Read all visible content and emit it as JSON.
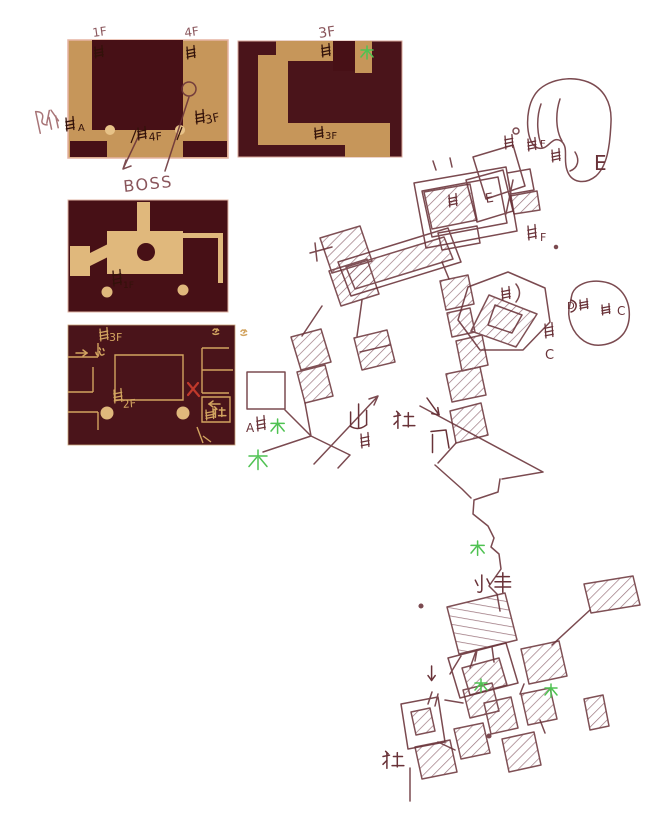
{
  "palette": {
    "paper": "#ffffff",
    "maroon": "#471016",
    "tan_map": "#c6965a",
    "tan_light": "#e7c288",
    "tan_room": "#e0b87c",
    "tan_line": "#d2a460",
    "pen": "#693238",
    "pen_soft": "#8a565c",
    "ink": "#33120a",
    "green": "#4fc252",
    "red": "#c0392b",
    "pink": "#a87578"
  },
  "floor_maps": [
    {
      "name": "floor-map-1",
      "top_labels": [
        "1F",
        "4F"
      ],
      "inner_labels": [
        "A",
        "4F",
        "3F"
      ],
      "callout": "BOSS"
    },
    {
      "name": "floor-map-2",
      "top_labels": [
        "3F"
      ],
      "inner_labels": [
        "3F"
      ],
      "marks": [
        "木"
      ]
    },
    {
      "name": "floor-map-3",
      "inner_labels": [
        "1F"
      ]
    },
    {
      "name": "floor-map-4",
      "inner_labels": [
        "3F",
        "心",
        "2F",
        "社"
      ],
      "marks": [
        "→",
        "←",
        "✕",
        "逃",
        "遥"
      ]
    }
  ],
  "sketch_labels": [
    {
      "t": "1F",
      "x": 93,
      "y": 37,
      "s": 12,
      "c": "pen_soft",
      "r": -8,
      "name": "label-map1-1f"
    },
    {
      "t": "4F",
      "x": 185,
      "y": 37,
      "s": 12,
      "c": "pen_soft",
      "r": -8,
      "name": "label-map1-4f"
    },
    {
      "t": "3F",
      "x": 319,
      "y": 38,
      "s": 14,
      "c": "pen_soft",
      "r": -8,
      "name": "label-map2-3f"
    },
    {
      "t": "4F",
      "x": 149,
      "y": 141,
      "s": 11,
      "c": "ink",
      "r": -5,
      "name": "label-stairs-4f"
    },
    {
      "t": "3F",
      "x": 206,
      "y": 124,
      "s": 12,
      "c": "ink",
      "r": -12,
      "name": "label-stairs-3f"
    },
    {
      "t": "A",
      "x": 78,
      "y": 131,
      "s": 10,
      "c": "ink",
      "r": 0,
      "name": "label-stairs-a"
    },
    {
      "t": "BOSS",
      "x": 124,
      "y": 192,
      "s": 16,
      "c": "pen_soft",
      "r": -6,
      "ls": 1.5,
      "name": "label-boss"
    },
    {
      "t": "3F",
      "x": 325,
      "y": 139,
      "s": 10,
      "c": "ink",
      "r": 0,
      "name": "label-map2-stairs-3f"
    },
    {
      "t": "1F",
      "x": 123,
      "y": 288,
      "s": 9,
      "c": "ink",
      "r": 0,
      "name": "label-map3-stairs-1f"
    },
    {
      "t": "3F",
      "x": 109,
      "y": 341,
      "s": 11,
      "c": "tan_line",
      "r": 0,
      "name": "label-map4-stairs-3f"
    },
    {
      "t": "2F",
      "x": 123,
      "y": 408,
      "s": 11,
      "c": "tan_line",
      "r": -5,
      "name": "label-map4-stairs-2f"
    },
    {
      "t": "E",
      "x": 594,
      "y": 170,
      "s": 20,
      "c": "pen",
      "r": 0,
      "name": "label-area-e"
    },
    {
      "t": "E",
      "x": 486,
      "y": 203,
      "s": 13,
      "c": "pen",
      "r": -10,
      "name": "label-area-e2"
    },
    {
      "t": "F",
      "x": 540,
      "y": 147,
      "s": 10,
      "c": "pen",
      "r": 0,
      "name": "label-area-f"
    },
    {
      "t": "F",
      "x": 540,
      "y": 241,
      "s": 11,
      "c": "pen",
      "r": 0,
      "name": "label-area-f2"
    },
    {
      "t": "C",
      "x": 545,
      "y": 359,
      "s": 13,
      "c": "pen",
      "r": 0,
      "name": "label-area-c"
    },
    {
      "t": "C",
      "x": 617,
      "y": 315,
      "s": 12,
      "c": "pen",
      "r": 0,
      "name": "label-area-c2"
    },
    {
      "t": "D",
      "x": 567,
      "y": 309,
      "s": 10,
      "c": "pen",
      "r": 0,
      "name": "label-area-d"
    },
    {
      "t": "A",
      "x": 246,
      "y": 432,
      "s": 12,
      "c": "pen",
      "r": 0,
      "name": "label-area-a"
    }
  ],
  "glyphs": [
    {
      "char": "阶",
      "type": "jie",
      "x": 34,
      "y": 112,
      "s": 1.7,
      "c": "pink",
      "r": -12,
      "name": "stairs-character-glyph"
    },
    {
      "char": "木",
      "type": "mu",
      "x": 361,
      "y": 46,
      "s": 1.0,
      "c": "green",
      "name": "tree-mark-map2"
    },
    {
      "char": "心",
      "type": "xin",
      "x": 95,
      "y": 347,
      "s": 0.9,
      "c": "tan_line",
      "name": "heart-character-glyph"
    },
    {
      "char": "→",
      "type": "arrowr",
      "x": 76,
      "y": 351,
      "s": 1,
      "c": "tan_line",
      "name": "arrow-right-icon"
    },
    {
      "char": "←",
      "type": "arrowl",
      "x": 208,
      "y": 402,
      "s": 1,
      "c": "tan_line",
      "name": "arrow-left-icon"
    },
    {
      "char": "社",
      "type": "she",
      "x": 213,
      "y": 406,
      "s": 0.8,
      "c": "tan_line",
      "name": "shrine-character-map4"
    },
    {
      "char": "逃",
      "type": "squig",
      "x": 213,
      "y": 328,
      "s": 0.8,
      "c": "tan_line",
      "name": "escape-character-glyph"
    },
    {
      "char": "遥",
      "type": "squig",
      "x": 241,
      "y": 329,
      "s": 0.8,
      "c": "tan_line",
      "name": "far-character-glyph"
    },
    {
      "char": "木",
      "type": "mu",
      "x": 271,
      "y": 419,
      "s": 1.1,
      "c": "green",
      "name": "tree-mark-a"
    },
    {
      "char": "木",
      "type": "mu",
      "x": 249,
      "y": 450,
      "s": 1.5,
      "c": "green",
      "name": "tree-mark-a2"
    },
    {
      "char": "山",
      "type": "shan",
      "x": 349,
      "y": 404,
      "s": 1.6,
      "c": "pen",
      "name": "mountain-character-glyph"
    },
    {
      "char": "社",
      "type": "she",
      "x": 394,
      "y": 410,
      "s": 1.3,
      "c": "pen",
      "name": "shrine-character-mid"
    },
    {
      "char": "↓",
      "type": "arrowdr",
      "x": 427,
      "y": 398,
      "s": 1.2,
      "c": "pen",
      "name": "arrow-down-icon"
    },
    {
      "char": "门",
      "type": "men",
      "x": 431,
      "y": 430,
      "s": 1.5,
      "c": "pen",
      "name": "gate-character-glyph"
    },
    {
      "char": "木",
      "type": "mu",
      "x": 471,
      "y": 541,
      "s": 1.1,
      "c": "green",
      "name": "tree-mark-path"
    },
    {
      "char": "小",
      "type": "xiao",
      "x": 474,
      "y": 575,
      "s": 1.3,
      "c": "pen",
      "name": "small-character-glyph"
    },
    {
      "char": "丰",
      "type": "feng",
      "x": 495,
      "y": 574,
      "s": 1.3,
      "c": "pen",
      "name": "feng-character-glyph"
    },
    {
      "char": "↓",
      "type": "arrowd",
      "x": 428,
      "y": 666,
      "s": 1.2,
      "c": "pen",
      "name": "arrow-down-icon-2"
    },
    {
      "char": "木",
      "type": "mu",
      "x": 475,
      "y": 679,
      "s": 1.0,
      "c": "green",
      "name": "tree-mark-cluster"
    },
    {
      "char": "木",
      "type": "mu",
      "x": 545,
      "y": 684,
      "s": 1.0,
      "c": "green",
      "name": "tree-mark-cluster2"
    },
    {
      "char": "社",
      "type": "she",
      "x": 383,
      "y": 750,
      "s": 1.3,
      "c": "pen",
      "name": "shrine-character-bottom"
    },
    {
      "char": "✕",
      "type": "xmark",
      "x": 188,
      "y": 383,
      "s": 1,
      "c": "red",
      "name": "red-x-mark"
    },
    {
      "char": "D",
      "type": "dloop",
      "x": 570,
      "y": 300,
      "s": 1,
      "c": "pen",
      "name": "d-loop-glyph"
    }
  ],
  "ladders": [
    {
      "x": 95,
      "y": 47,
      "h": 11,
      "c": "ink"
    },
    {
      "x": 187,
      "y": 47,
      "h": 12,
      "c": "ink"
    },
    {
      "x": 66,
      "y": 118,
      "h": 13,
      "c": "ink"
    },
    {
      "x": 138,
      "y": 128,
      "h": 12,
      "c": "ink"
    },
    {
      "x": 196,
      "y": 111,
      "h": 13,
      "c": "ink"
    },
    {
      "x": 322,
      "y": 45,
      "h": 12,
      "c": "ink"
    },
    {
      "x": 315,
      "y": 128,
      "h": 11,
      "c": "ink"
    },
    {
      "x": 113,
      "y": 271,
      "h": 15,
      "c": "ink"
    },
    {
      "x": 100,
      "y": 329,
      "h": 12,
      "c": "tan_line"
    },
    {
      "x": 114,
      "y": 390,
      "h": 13,
      "c": "tan_line"
    },
    {
      "x": 206,
      "y": 410,
      "h": 10,
      "c": "tan_line"
    },
    {
      "x": 505,
      "y": 136,
      "h": 13,
      "c": "pen"
    },
    {
      "x": 528,
      "y": 139,
      "h": 12,
      "c": "pen"
    },
    {
      "x": 552,
      "y": 150,
      "h": 12,
      "c": "pen"
    },
    {
      "x": 528,
      "y": 226,
      "h": 14,
      "c": "pen"
    },
    {
      "x": 449,
      "y": 195,
      "h": 12,
      "c": "pen"
    },
    {
      "x": 502,
      "y": 288,
      "h": 12,
      "c": "pen"
    },
    {
      "x": 545,
      "y": 324,
      "h": 14,
      "c": "pen"
    },
    {
      "x": 580,
      "y": 300,
      "h": 10,
      "c": "pen"
    },
    {
      "x": 602,
      "y": 305,
      "h": 10,
      "c": "pen"
    },
    {
      "x": 361,
      "y": 434,
      "h": 14,
      "c": "pen"
    },
    {
      "x": 257,
      "y": 417,
      "h": 14,
      "c": "pen"
    }
  ]
}
